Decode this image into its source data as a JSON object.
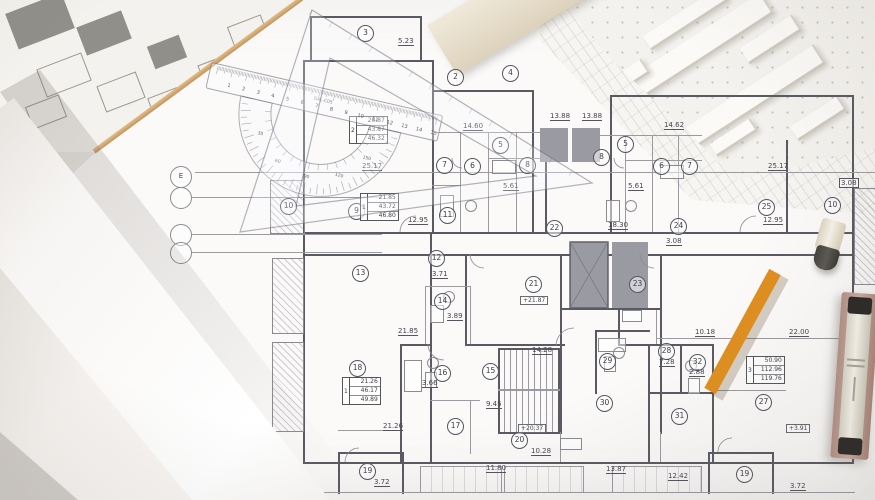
{
  "photo": {
    "floor_plan": {
      "axis_labels": [
        "E",
        "",
        "",
        ""
      ],
      "rooms": [
        {
          "n": "3",
          "x": 365,
          "y": 33
        },
        {
          "n": "2",
          "x": 455,
          "y": 77
        },
        {
          "n": "4",
          "x": 510,
          "y": 73
        },
        {
          "n": "5",
          "x": 500,
          "y": 145
        },
        {
          "n": "7",
          "x": 444,
          "y": 165
        },
        {
          "n": "6",
          "x": 472,
          "y": 166
        },
        {
          "n": "8",
          "x": 527,
          "y": 165
        },
        {
          "n": "8",
          "x": 601,
          "y": 157
        },
        {
          "n": "5",
          "x": 625,
          "y": 144
        },
        {
          "n": "6",
          "x": 661,
          "y": 166
        },
        {
          "n": "7",
          "x": 689,
          "y": 166
        },
        {
          "n": "9",
          "x": 356,
          "y": 211
        },
        {
          "n": "10",
          "x": 288,
          "y": 206
        },
        {
          "n": "11",
          "x": 447,
          "y": 215
        },
        {
          "n": "22",
          "x": 554,
          "y": 228
        },
        {
          "n": "24",
          "x": 678,
          "y": 226
        },
        {
          "n": "25",
          "x": 766,
          "y": 207
        },
        {
          "n": "10",
          "x": 832,
          "y": 205
        },
        {
          "n": "12",
          "x": 436,
          "y": 258
        },
        {
          "n": "13",
          "x": 360,
          "y": 273
        },
        {
          "n": "23",
          "x": 637,
          "y": 284
        },
        {
          "n": "21",
          "x": 533,
          "y": 284
        },
        {
          "n": "14",
          "x": 442,
          "y": 301
        },
        {
          "n": "18",
          "x": 357,
          "y": 368
        },
        {
          "n": "16",
          "x": 442,
          "y": 373
        },
        {
          "n": "15",
          "x": 490,
          "y": 371
        },
        {
          "n": "17",
          "x": 455,
          "y": 426
        },
        {
          "n": "20",
          "x": 519,
          "y": 440
        },
        {
          "n": "29",
          "x": 607,
          "y": 361
        },
        {
          "n": "28",
          "x": 666,
          "y": 351
        },
        {
          "n": "32",
          "x": 697,
          "y": 362
        },
        {
          "n": "30",
          "x": 604,
          "y": 403
        },
        {
          "n": "31",
          "x": 679,
          "y": 416
        },
        {
          "n": "27",
          "x": 763,
          "y": 402
        },
        {
          "n": "19",
          "x": 367,
          "y": 471
        },
        {
          "n": "19",
          "x": 744,
          "y": 474
        }
      ],
      "dimensions": [
        {
          "t": "5.23",
          "x": 398,
          "y": 41,
          "s": "u"
        },
        {
          "t": "14.60",
          "x": 463,
          "y": 126,
          "s": "u"
        },
        {
          "t": "13.88",
          "x": 550,
          "y": 116,
          "s": "u"
        },
        {
          "t": "13.88",
          "x": 582,
          "y": 116,
          "s": "u"
        },
        {
          "t": "14.62",
          "x": 664,
          "y": 125,
          "s": "u"
        },
        {
          "t": "5.61",
          "x": 503,
          "y": 186,
          "s": "u"
        },
        {
          "t": "5.61",
          "x": 628,
          "y": 186,
          "s": "u"
        },
        {
          "t": "25.17",
          "x": 362,
          "y": 166,
          "s": "u"
        },
        {
          "t": "25.17",
          "x": 768,
          "y": 166,
          "s": "u"
        },
        {
          "t": "12.95",
          "x": 408,
          "y": 220,
          "s": "u"
        },
        {
          "t": "12.95",
          "x": 763,
          "y": 220,
          "s": "u"
        },
        {
          "t": "18.30",
          "x": 608,
          "y": 225,
          "s": "u"
        },
        {
          "t": "3.08",
          "x": 666,
          "y": 241,
          "s": "u"
        },
        {
          "t": "3.08",
          "x": 839,
          "y": 182,
          "s": "b"
        },
        {
          "t": "3.71",
          "x": 432,
          "y": 274,
          "s": "u"
        },
        {
          "t": "3.89",
          "x": 447,
          "y": 316,
          "s": "u"
        },
        {
          "t": "21.85",
          "x": 398,
          "y": 331,
          "s": "u"
        },
        {
          "t": "3.66",
          "x": 422,
          "y": 383,
          "s": "u"
        },
        {
          "t": "21.26",
          "x": 383,
          "y": 426,
          "s": "u"
        },
        {
          "t": "14.28",
          "x": 532,
          "y": 350,
          "s": "u"
        },
        {
          "t": "9.45",
          "x": 486,
          "y": 404,
          "s": "u"
        },
        {
          "t": "11.80",
          "x": 486,
          "y": 468,
          "s": "u"
        },
        {
          "t": "10.28",
          "x": 531,
          "y": 451,
          "s": "u"
        },
        {
          "t": "13.87",
          "x": 606,
          "y": 469,
          "s": "u"
        },
        {
          "t": "12.42",
          "x": 668,
          "y": 476,
          "s": "u"
        },
        {
          "t": "3.72",
          "x": 374,
          "y": 482,
          "s": "u"
        },
        {
          "t": "3.72",
          "x": 790,
          "y": 486,
          "s": "u"
        },
        {
          "t": "7.28",
          "x": 659,
          "y": 362,
          "s": "u"
        },
        {
          "t": "2.88",
          "x": 689,
          "y": 372,
          "s": "u"
        },
        {
          "t": "10.18",
          "x": 695,
          "y": 332,
          "s": "u"
        },
        {
          "t": "22.00",
          "x": 789,
          "y": 332,
          "s": "u"
        }
      ],
      "area_tables": [
        {
          "apt": "2",
          "x": 349,
          "y": 116,
          "rows": [
            "20.87",
            "43.87",
            "46.32"
          ]
        },
        {
          "apt": "1",
          "x": 360,
          "y": 193,
          "rows": [
            "21.85",
            "43.72",
            "46.80"
          ]
        },
        {
          "apt": "1",
          "x": 342,
          "y": 377,
          "rows": [
            "21.26",
            "46.17",
            "49.89"
          ]
        },
        {
          "apt": "3",
          "x": 746,
          "y": 356,
          "rows": [
            "50.90",
            "112.96",
            "119.76"
          ]
        }
      ],
      "level_markers": [
        {
          "t": "+21.87",
          "x": 520,
          "y": 296
        },
        {
          "t": "+20.37",
          "x": 518,
          "y": 424
        },
        {
          "t": "+3.91",
          "x": 786,
          "y": 424
        }
      ]
    },
    "protractor": {
      "brand": "GAL-C05",
      "degree_labels": [
        "30",
        "60",
        "90",
        "120",
        "150"
      ],
      "ruler_numbers": [
        "1",
        "2",
        "3",
        "4",
        "5",
        "6",
        "7",
        "8",
        "9",
        "10",
        "11",
        "12",
        "13",
        "14",
        "15"
      ]
    },
    "colors": {
      "desk": "#eae8e4",
      "paper": "#fbfaf9",
      "plan_line": "#5a5a62",
      "pencil_orange": "#f09d2c",
      "wood_edge": "#cfa369",
      "case_pink": "#c3a49c"
    }
  }
}
